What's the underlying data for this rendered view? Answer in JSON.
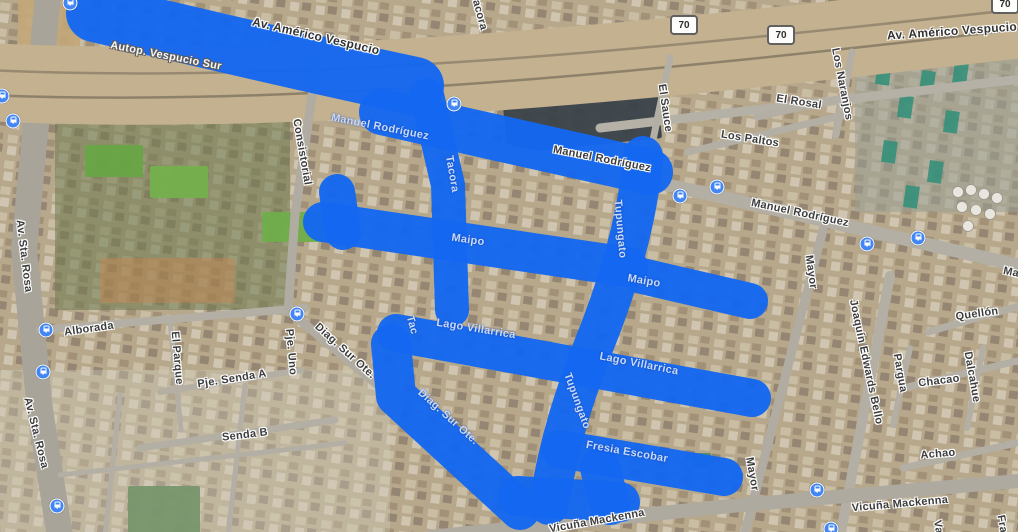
{
  "map": {
    "description": "Satellite map view with highlighted route streets",
    "highlight_color": "#1467f0",
    "bus_icon_color": "#4285f4",
    "base_color": "#b7a88c",
    "street_labels": [
      {
        "text": "Av. Américo Vespucio",
        "x": 316,
        "y": 36,
        "rot": 13,
        "big": true
      },
      {
        "text": "Av. Américo Vespucio",
        "x": 952,
        "y": 31,
        "rot": -4,
        "big": true
      },
      {
        "text": "Tacora",
        "x": 479,
        "y": 12,
        "rot": 75
      },
      {
        "text": "El Sauce",
        "x": 665,
        "y": 108,
        "rot": 82
      },
      {
        "text": "Los Paltos",
        "x": 750,
        "y": 139,
        "rot": 9
      },
      {
        "text": "El Rosal",
        "x": 799,
        "y": 102,
        "rot": 9
      },
      {
        "text": "Los Naranjos",
        "x": 842,
        "y": 84,
        "rot": 79
      },
      {
        "text": "Manuel Rodríguez",
        "x": 800,
        "y": 213,
        "rot": 12
      },
      {
        "text": "Manuel Rodríguez",
        "x": 602,
        "y": 159,
        "rot": 11
      },
      {
        "text": "Manuel Rodríguez",
        "x": 1052,
        "y": 281,
        "rot": 12
      },
      {
        "text": "Consistorial",
        "x": 302,
        "y": 152,
        "rot": 80
      },
      {
        "text": "Av. Sta. Rosa",
        "x": 24,
        "y": 256,
        "rot": 83
      },
      {
        "text": "Av. Sta. Rosa",
        "x": 36,
        "y": 433,
        "rot": 76
      },
      {
        "text": "Alborada",
        "x": 89,
        "y": 329,
        "rot": -8
      },
      {
        "text": "El Parque",
        "x": 177,
        "y": 358,
        "rot": 85
      },
      {
        "text": "Pje. Senda A",
        "x": 232,
        "y": 379,
        "rot": -9
      },
      {
        "text": "Pje. Uno",
        "x": 291,
        "y": 352,
        "rot": 85
      },
      {
        "text": "Senda B",
        "x": 245,
        "y": 435,
        "rot": -7
      },
      {
        "text": "Diag. Sur Ote.",
        "x": 345,
        "y": 351,
        "rot": 42
      },
      {
        "text": "Mayor",
        "x": 811,
        "y": 272,
        "rot": 82
      },
      {
        "text": "Mayor",
        "x": 752,
        "y": 474,
        "rot": 80
      },
      {
        "text": "Quellón",
        "x": 977,
        "y": 314,
        "rot": -8
      },
      {
        "text": "Joaquín Edwards Bello",
        "x": 866,
        "y": 362,
        "rot": 78
      },
      {
        "text": "Pargua",
        "x": 900,
        "y": 373,
        "rot": 80
      },
      {
        "text": "Chacao",
        "x": 939,
        "y": 381,
        "rot": -7
      },
      {
        "text": "Dalcahue",
        "x": 972,
        "y": 377,
        "rot": 80
      },
      {
        "text": "Achao",
        "x": 938,
        "y": 454,
        "rot": -5
      },
      {
        "text": "Vicuña Mackenna",
        "x": 597,
        "y": 521,
        "rot": -10
      },
      {
        "text": "Vicuña Mackenna",
        "x": 900,
        "y": 504,
        "rot": -5
      },
      {
        "text": "Va",
        "x": 938,
        "y": 527,
        "rot": 80
      },
      {
        "text": "Fra",
        "x": 1002,
        "y": 524,
        "rot": 80
      }
    ],
    "highway_labels": [
      {
        "text": "Autop. Vespucio Sur",
        "x": 166,
        "y": 56,
        "rot": 11
      }
    ],
    "on_route_labels": [
      {
        "text": "Manuel Rodríguez",
        "x": 380,
        "y": 127,
        "rot": 11
      },
      {
        "text": "Tacora",
        "x": 452,
        "y": 174,
        "rot": 80
      },
      {
        "text": "Maipo",
        "x": 468,
        "y": 240,
        "rot": 8
      },
      {
        "text": "Maipo",
        "x": 644,
        "y": 281,
        "rot": 10
      },
      {
        "text": "Lago Villarrica",
        "x": 476,
        "y": 329,
        "rot": 9
      },
      {
        "text": "Lago Villarrica",
        "x": 639,
        "y": 364,
        "rot": 11
      },
      {
        "text": "Tupungato",
        "x": 620,
        "y": 229,
        "rot": 85
      },
      {
        "text": "Tupungato",
        "x": 577,
        "y": 401,
        "rot": 70
      },
      {
        "text": "Tac",
        "x": 412,
        "y": 325,
        "rot": 75
      },
      {
        "text": "Diag. Sur Ote.",
        "x": 448,
        "y": 417,
        "rot": 42
      },
      {
        "text": "Fresia Escobar",
        "x": 627,
        "y": 452,
        "rot": 10
      }
    ],
    "route_shields": [
      {
        "text": "70",
        "x": 684,
        "y": 25
      },
      {
        "text": "70",
        "x": 781,
        "y": 35
      },
      {
        "text": "70",
        "x": 1005,
        "y": 4
      }
    ],
    "bus_stops": [
      {
        "x": 70,
        "y": 3
      },
      {
        "x": 2,
        "y": 96
      },
      {
        "x": 13,
        "y": 121
      },
      {
        "x": 454,
        "y": 104
      },
      {
        "x": 680,
        "y": 196
      },
      {
        "x": 717,
        "y": 187
      },
      {
        "x": 867,
        "y": 244
      },
      {
        "x": 918,
        "y": 238
      },
      {
        "x": 46,
        "y": 330
      },
      {
        "x": 43,
        "y": 372
      },
      {
        "x": 297,
        "y": 314
      },
      {
        "x": 57,
        "y": 506
      },
      {
        "x": 817,
        "y": 490
      },
      {
        "x": 831,
        "y": 529
      }
    ],
    "route_strokes": [
      {
        "name": "autopista-vespucio-sur",
        "d": "M95,13 C200,38 320,66 415,86",
        "w": 58
      },
      {
        "name": "manuel-rodriguez-west",
        "d": "M382,112 L650,172",
        "w": 46
      },
      {
        "name": "tacora",
        "d": "M427,95 L448,185 L452,310",
        "w": 34
      },
      {
        "name": "maipo-stub",
        "d": "M337,192 L343,232",
        "w": 36
      },
      {
        "name": "maipo",
        "d": "M323,222 L628,267",
        "w": 40
      },
      {
        "name": "maipo-east",
        "d": "M642,276 L750,301",
        "w": 36
      },
      {
        "name": "tupungato",
        "d": "M643,156 C637,230 612,300 594,345 C577,388 559,440 549,505",
        "w": 40
      },
      {
        "name": "lago-villarrica",
        "d": "M396,333 L752,398",
        "w": 38
      },
      {
        "name": "fresia-escobar",
        "d": "M560,449 L724,477",
        "w": 38
      },
      {
        "name": "diag-sur-ote",
        "d": "M391,344 L396,396 L520,510",
        "w": 40
      },
      {
        "name": "bottom-connector",
        "d": "M518,496 L620,502",
        "w": 40
      },
      {
        "name": "tupungato-foot",
        "d": "M600,468 L610,505",
        "w": 40
      }
    ],
    "roads": [
      {
        "name": "av-sta-rosa",
        "d": "M48,-5 L24,250 L40,410 L60,537",
        "w": 26,
        "c": "#a8a49a"
      },
      {
        "name": "vespucio-corridor",
        "d": "M-15,82 C300,98 650,62 1030,18",
        "w": 78,
        "c": "#c3b190"
      },
      {
        "name": "rail-1",
        "d": "M-15,95 C300,108 650,72 1030,28",
        "w": 2.5,
        "c": "#8d8169"
      },
      {
        "name": "rail-2",
        "d": "M-15,70 C300,85 650,50 1030,8",
        "w": 2.5,
        "c": "#978a70"
      },
      {
        "name": "vespucio-service",
        "d": "M600,128 L1030,78",
        "w": 9,
        "c": "#b5b1a7"
      },
      {
        "name": "manuel-rodriguez",
        "d": "M420,132 L700,192 L1030,268",
        "w": 13,
        "c": "#b3afa5"
      },
      {
        "name": "consistorial",
        "d": "M320,40 L295,215 L288,312",
        "w": 9,
        "c": "#b0aca2"
      },
      {
        "name": "alborada",
        "d": "M40,330 L305,308",
        "w": 8,
        "c": "#b3afa5"
      },
      {
        "name": "pje-senda-a",
        "d": "M160,392 L302,370",
        "w": 6,
        "c": "#b3afa5"
      },
      {
        "name": "senda-b",
        "d": "M140,448 L335,420",
        "w": 7,
        "c": "#b3afa5"
      },
      {
        "name": "diag-sur-ote-west",
        "d": "M288,310 L398,402",
        "w": 9,
        "c": "#b0aca2"
      },
      {
        "name": "mayor",
        "d": "M823,230 L744,537",
        "w": 9,
        "c": "#b0aca2"
      },
      {
        "name": "joaquin-edwards-bello",
        "d": "M890,276 L840,537",
        "w": 10,
        "c": "#b3afa5"
      },
      {
        "name": "vicuna-mackenna",
        "d": "M430,537 L730,506 L1030,480",
        "w": 14,
        "c": "#aeaaa0"
      },
      {
        "name": "quellon",
        "d": "M928,332 L1030,303",
        "w": 7,
        "c": "#b3afa5"
      },
      {
        "name": "chacao",
        "d": "M903,388 L1030,358",
        "w": 7,
        "c": "#b3afa5"
      },
      {
        "name": "achao",
        "d": "M903,468 L1030,440",
        "w": 7,
        "c": "#b3afa5"
      },
      {
        "name": "pargua",
        "d": "M910,348 L893,425",
        "w": 6,
        "c": "#b3afa5"
      },
      {
        "name": "dalcahue",
        "d": "M983,348 L967,428",
        "w": 6,
        "c": "#b3afa5"
      },
      {
        "name": "el-sauce",
        "d": "M670,58 L653,140",
        "w": 7,
        "c": "#b3afa5"
      },
      {
        "name": "los-paltos",
        "d": "M688,152 L845,115",
        "w": 7,
        "c": "#b3afa5"
      },
      {
        "name": "el-rosal",
        "d": "M757,117 L852,96",
        "w": 7,
        "c": "#b3afa5"
      },
      {
        "name": "los-naranjos",
        "d": "M852,52 L836,135",
        "w": 7,
        "c": "#b3afa5"
      },
      {
        "name": "el-parque",
        "d": "M170,320 L181,430",
        "w": 5,
        "c": "#b3afa5"
      },
      {
        "name": "barrio-1",
        "d": "M60,475 L345,443",
        "w": 5,
        "c": "#b3afa5"
      },
      {
        "name": "barrio-2",
        "d": "M245,385 L228,537",
        "w": 5,
        "c": "#b3afa5"
      },
      {
        "name": "barrio-3",
        "d": "M120,395 L105,537",
        "w": 5,
        "c": "#b3afa5"
      }
    ],
    "patches": [
      {
        "name": "park-green",
        "x": 55,
        "y": 60,
        "w": 235,
        "h": 250,
        "c": "#6e7a4e",
        "o": 0.55
      },
      {
        "name": "warehouse-topleft",
        "x": 18,
        "y": 0,
        "w": 62,
        "h": 58,
        "c": "#c2a678",
        "o": 0.9
      },
      {
        "name": "court-1",
        "x": 85,
        "y": 145,
        "w": 58,
        "h": 32,
        "c": "#67a744",
        "o": 0.95
      },
      {
        "name": "court-2",
        "x": 150,
        "y": 166,
        "w": 58,
        "h": 32,
        "c": "#74b14c",
        "o": 0.95
      },
      {
        "name": "court-3",
        "x": 262,
        "y": 212,
        "w": 66,
        "h": 30,
        "c": "#6fae4b",
        "o": 0.95
      },
      {
        "name": "dirt-field",
        "x": 100,
        "y": 258,
        "w": 135,
        "h": 45,
        "c": "#c8854f",
        "o": 0.45
      },
      {
        "name": "school-roof",
        "x": 505,
        "y": 98,
        "w": 155,
        "h": 48,
        "c": "#39424a",
        "o": 0.95,
        "rot": -6
      },
      {
        "name": "soccer-field",
        "x": 128,
        "y": 486,
        "w": 72,
        "h": 48,
        "c": "#4c7a44",
        "o": 0.95
      },
      {
        "name": "small-field",
        "x": 512,
        "y": 482,
        "w": 38,
        "h": 30,
        "c": "#5d9150",
        "o": 0.9
      },
      {
        "name": "tiny-green",
        "x": 693,
        "y": 453,
        "w": 18,
        "h": 14,
        "c": "#4f8a5f",
        "o": 0.9
      },
      {
        "name": "barrio-light",
        "x": 0,
        "y": 370,
        "w": 390,
        "h": 162,
        "c": "#d5cfc2",
        "o": 0.32
      },
      {
        "name": "rowhouses-east",
        "x": 855,
        "y": 42,
        "w": 163,
        "h": 170,
        "c": "#9aa096",
        "o": 0.55
      }
    ],
    "teal_roofs": [
      {
        "x": 878,
        "y": 62
      },
      {
        "x": 900,
        "y": 95
      },
      {
        "x": 922,
        "y": 70
      },
      {
        "x": 946,
        "y": 110
      },
      {
        "x": 884,
        "y": 140
      },
      {
        "x": 930,
        "y": 160
      },
      {
        "x": 906,
        "y": 185
      },
      {
        "x": 955,
        "y": 62
      }
    ],
    "tanks": [
      {
        "x": 958,
        "y": 192
      },
      {
        "x": 971,
        "y": 190
      },
      {
        "x": 984,
        "y": 194
      },
      {
        "x": 997,
        "y": 198
      },
      {
        "x": 962,
        "y": 207
      },
      {
        "x": 976,
        "y": 210
      },
      {
        "x": 990,
        "y": 214
      },
      {
        "x": 968,
        "y": 226
      }
    ]
  }
}
